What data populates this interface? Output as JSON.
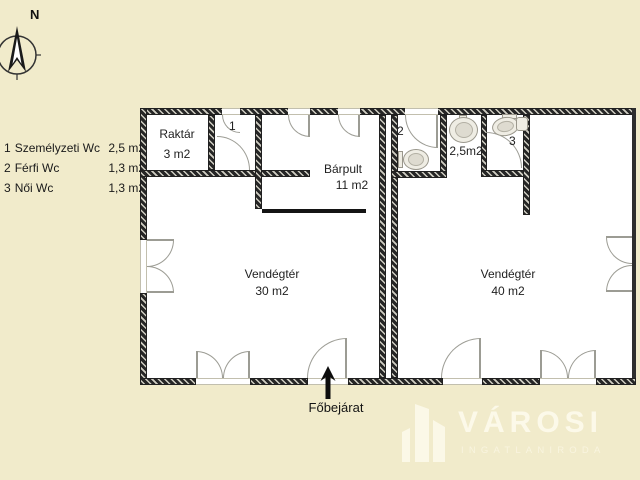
{
  "colors": {
    "background": "#f1ebcb",
    "wall": "#262626",
    "door_arc": "#9c9c94",
    "text": "#1f1f1f",
    "watermark": "#fdfaec"
  },
  "compass": {
    "north_label": "N"
  },
  "legend": {
    "items": [
      {
        "num": "1",
        "name": "Személyzeti Wc",
        "area": "2,5 m2"
      },
      {
        "num": "2",
        "name": "Férfi Wc",
        "area": "1,3 m2"
      },
      {
        "num": "3",
        "name": "Női Wc",
        "area": "1,3 m2"
      }
    ]
  },
  "plan": {
    "raktar": {
      "name": "Raktár",
      "area": "3 m2"
    },
    "barpult": {
      "name": "Bárpult",
      "area": "11 m2"
    },
    "vendegter_left": {
      "name": "Vendégtér",
      "area": "30 m2"
    },
    "vendegter_right": {
      "name": "Vendégtér",
      "area": "40 m2"
    },
    "wc1_label": "1",
    "wc2_label": "2",
    "wc3_label": "3",
    "wc_area_label": "2,5m2",
    "entrance_label": "Főbejárat"
  },
  "watermark": {
    "brand": "VÁROSI",
    "tagline": "INGATLANIRODA"
  }
}
